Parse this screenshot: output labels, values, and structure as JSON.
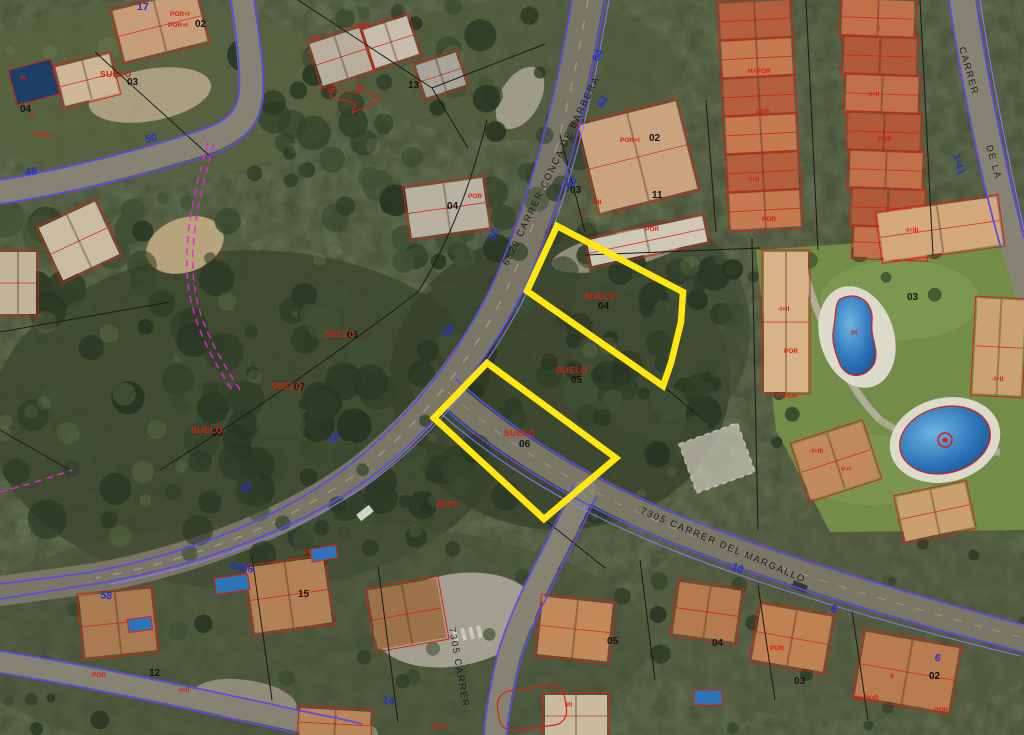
{
  "map": {
    "type": "cadastral-aerial-orthophoto",
    "highlight": {
      "color": "#ffe712",
      "selected_parcels": [
        "04",
        "06"
      ],
      "selected_parcel_label": "SUELO"
    },
    "colors": {
      "road_edge": "#5b4be0",
      "cadastral_red": "#d81f14",
      "boundary_magenta": "#e228d8",
      "house_number_blue": "#2230cc",
      "parcel_black": "#141414"
    },
    "labels": {
      "streets": [
        {
          "text": "6820 CARRER CONCA DE BARBERA",
          "x": 508,
          "y": 266,
          "rot": -64
        },
        {
          "text": "7305 CARRER DEL MARGALLO",
          "x": 640,
          "y": 513,
          "rot": 23
        },
        {
          "text": "7305 CARRER",
          "x": 449,
          "y": 628,
          "rot": 80
        },
        {
          "text": "CARRER",
          "x": 959,
          "y": 48,
          "rot": 74
        },
        {
          "text": "DE LA",
          "x": 986,
          "y": 146,
          "rot": 74
        }
      ],
      "house_numbers": [
        {
          "text": "48",
          "x": 26,
          "y": 176,
          "rot": -10
        },
        {
          "text": "50",
          "x": 146,
          "y": 143,
          "rot": -12
        },
        {
          "text": "17",
          "x": 137,
          "y": 10,
          "rot": 0
        },
        {
          "text": "64",
          "x": 598,
          "y": 62,
          "rot": -63
        },
        {
          "text": "62",
          "x": 603,
          "y": 108,
          "rot": -63
        },
        {
          "text": "60",
          "x": 572,
          "y": 190,
          "rot": -63
        },
        {
          "text": "58",
          "x": 494,
          "y": 241,
          "rot": -63
        },
        {
          "text": "56",
          "x": 448,
          "y": 337,
          "rot": -55
        },
        {
          "text": "54",
          "x": 333,
          "y": 444,
          "rot": -45
        },
        {
          "text": "52",
          "x": 243,
          "y": 493,
          "rot": -32
        },
        {
          "text": "58",
          "x": 100,
          "y": 598,
          "rot": 8
        },
        {
          "text": "10",
          "x": 731,
          "y": 569,
          "rot": 22
        },
        {
          "text": "8",
          "x": 830,
          "y": 611,
          "rot": 20
        },
        {
          "text": "6",
          "x": 934,
          "y": 660,
          "rot": 18
        },
        {
          "text": "14",
          "x": 382,
          "y": 703,
          "rot": 10
        },
        {
          "text": "6466",
          "x": 230,
          "y": 569,
          "rot": 10
        },
        {
          "text": "1-41",
          "x": 953,
          "y": 155,
          "rot": 74
        }
      ],
      "parcel_numbers": [
        {
          "text": "03",
          "x": 127,
          "y": 85
        },
        {
          "text": "13",
          "x": 408,
          "y": 88
        },
        {
          "text": "02",
          "x": 195,
          "y": 27
        },
        {
          "text": "04",
          "x": 447,
          "y": 209
        },
        {
          "text": "02",
          "x": 649,
          "y": 141
        },
        {
          "text": "03",
          "x": 570,
          "y": 193
        },
        {
          "text": "11",
          "x": 652,
          "y": 198
        },
        {
          "text": "04",
          "x": 598,
          "y": 309
        },
        {
          "text": "05",
          "x": 571,
          "y": 383
        },
        {
          "text": "06",
          "x": 519,
          "y": 447
        },
        {
          "text": "06",
          "x": 347,
          "y": 338
        },
        {
          "text": "07",
          "x": 294,
          "y": 390
        },
        {
          "text": "08",
          "x": 212,
          "y": 436
        },
        {
          "text": "12",
          "x": 149,
          "y": 676
        },
        {
          "text": "15",
          "x": 298,
          "y": 597
        },
        {
          "text": "05",
          "x": 607,
          "y": 644
        },
        {
          "text": "04",
          "x": 712,
          "y": 646
        },
        {
          "text": "03",
          "x": 794,
          "y": 684
        },
        {
          "text": "02",
          "x": 929,
          "y": 679
        },
        {
          "text": "03",
          "x": 907,
          "y": 300
        },
        {
          "text": "04",
          "x": 20,
          "y": 112
        }
      ],
      "red_parcel_labels": [
        {
          "text": "SUELO",
          "x": 584,
          "y": 299
        },
        {
          "text": "SUELO",
          "x": 556,
          "y": 373
        },
        {
          "text": "SUELO",
          "x": 504,
          "y": 436
        },
        {
          "text": "SUELO",
          "x": 324,
          "y": 337
        },
        {
          "text": "SUELO",
          "x": 271,
          "y": 389
        },
        {
          "text": "SUELO",
          "x": 191,
          "y": 433
        },
        {
          "text": "SUELO",
          "x": 100,
          "y": 77
        },
        {
          "text": "5070",
          "x": 437,
          "y": 507
        }
      ],
      "red_codes": [
        {
          "text": "POR+I",
          "x": 170,
          "y": 16
        },
        {
          "text": "POR+I",
          "x": 168,
          "y": 27
        },
        {
          "text": "PI",
          "x": 20,
          "y": 80
        },
        {
          "text": "II",
          "x": 30,
          "y": 118
        },
        {
          "text": "POR+I",
          "x": 34,
          "y": 137
        },
        {
          "text": "I+II",
          "x": 310,
          "y": 40
        },
        {
          "text": "POR",
          "x": 356,
          "y": 28
        },
        {
          "text": "PI",
          "x": 328,
          "y": 93
        },
        {
          "text": "POR",
          "x": 468,
          "y": 198
        },
        {
          "text": "POR+I",
          "x": 620,
          "y": 142
        },
        {
          "text": "+III",
          "x": 592,
          "y": 204
        },
        {
          "text": "A",
          "x": 580,
          "y": 217
        },
        {
          "text": "POR",
          "x": 645,
          "y": 231
        },
        {
          "text": "H+POR",
          "x": 748,
          "y": 73
        },
        {
          "text": "POR",
          "x": 756,
          "y": 114
        },
        {
          "text": "-I+II",
          "x": 748,
          "y": 181
        },
        {
          "text": "POR",
          "x": 762,
          "y": 221
        },
        {
          "text": "I",
          "x": 878,
          "y": 30
        },
        {
          "text": "-I+II",
          "x": 868,
          "y": 96
        },
        {
          "text": "POR",
          "x": 878,
          "y": 141
        },
        {
          "text": "-I+III",
          "x": 905,
          "y": 232
        },
        {
          "text": "PI",
          "x": 851,
          "y": 335
        },
        {
          "text": "-I+II",
          "x": 992,
          "y": 381
        },
        {
          "text": "-I+III",
          "x": 810,
          "y": 453
        },
        {
          "text": "V+I",
          "x": 841,
          "y": 471
        },
        {
          "text": "-I+II",
          "x": 778,
          "y": 311
        },
        {
          "text": "POR",
          "x": 784,
          "y": 353
        },
        {
          "text": "-I+POR",
          "x": 776,
          "y": 398
        },
        {
          "text": "POR",
          "x": 92,
          "y": 677
        },
        {
          "text": "-I+II",
          "x": 178,
          "y": 692
        },
        {
          "text": "PI",
          "x": 304,
          "y": 554
        },
        {
          "text": "H+POR",
          "x": 856,
          "y": 700
        },
        {
          "text": "POR",
          "x": 934,
          "y": 712
        },
        {
          "text": "I",
          "x": 964,
          "y": 712
        },
        {
          "text": "II",
          "x": 890,
          "y": 678
        },
        {
          "text": "PI",
          "x": 566,
          "y": 707
        },
        {
          "text": "POR",
          "x": 432,
          "y": 729
        },
        {
          "text": "POR",
          "x": 770,
          "y": 650
        }
      ]
    }
  }
}
